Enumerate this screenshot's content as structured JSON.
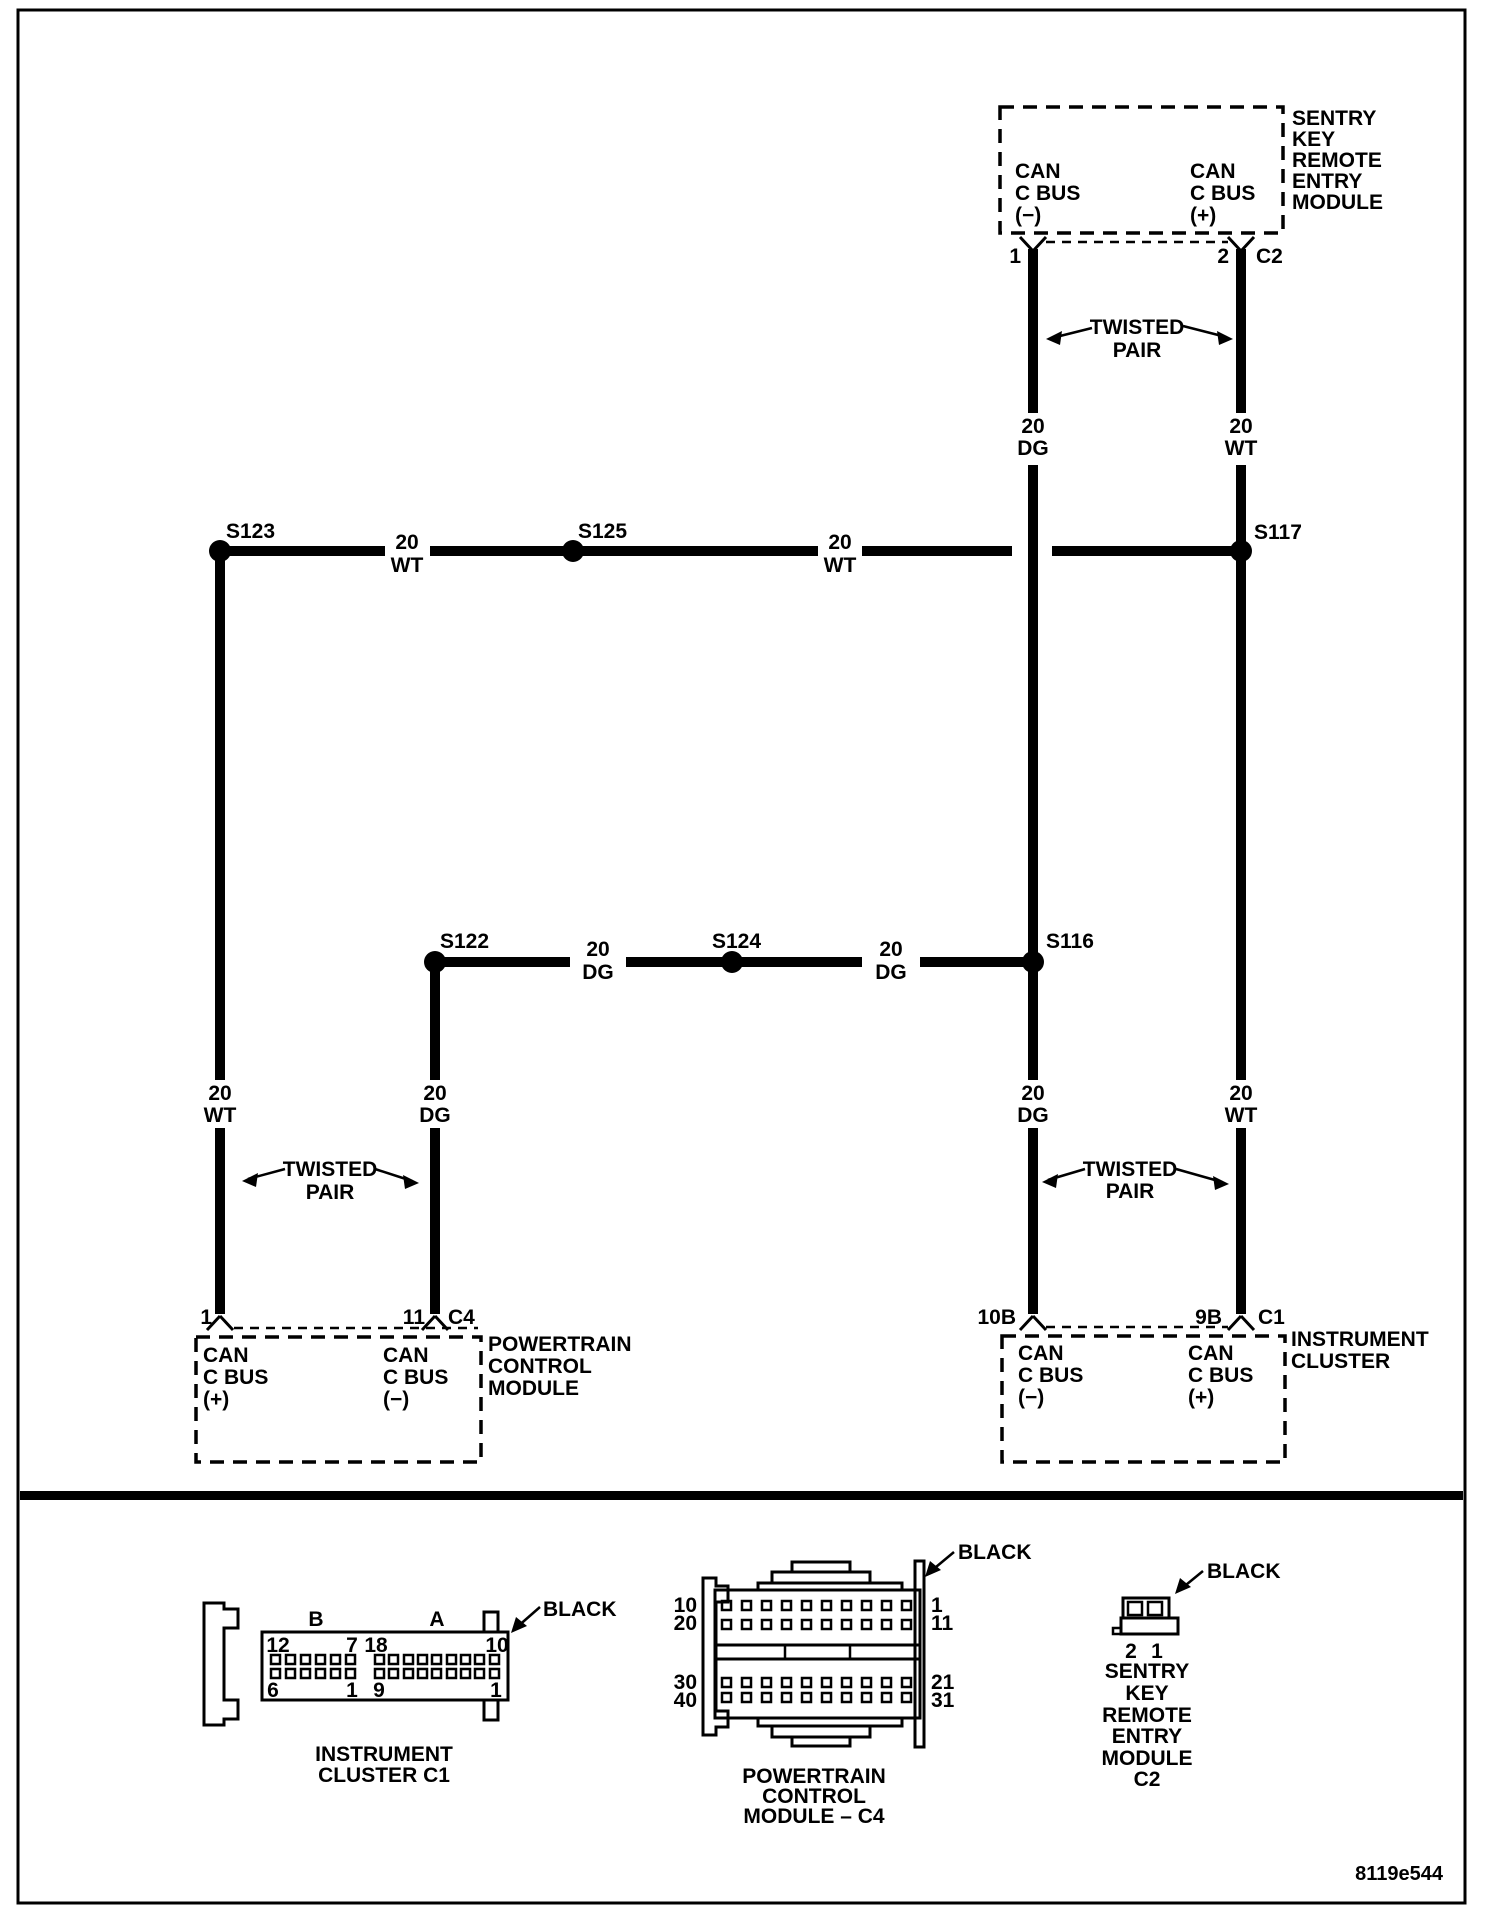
{
  "figure_number": "8119e544",
  "labels": {
    "gauge": "20",
    "wt": "WT",
    "dg": "DG",
    "twisted": "TWISTED",
    "pair": "PAIR",
    "black": "BLACK",
    "can": "CAN",
    "cbus": "C BUS",
    "plus": "(+)",
    "minus": "(−)"
  },
  "splices": {
    "s123": "S123",
    "s125": "S125",
    "s117": "S117",
    "s122": "S122",
    "s124": "S124",
    "s116": "S116"
  },
  "skreem": {
    "name": [
      "SENTRY",
      "KEY",
      "REMOTE",
      "ENTRY",
      "MODULE"
    ],
    "pin1": "1",
    "pin2": "2",
    "connector": "C2"
  },
  "pcm": {
    "name": [
      "POWERTRAIN",
      "CONTROL",
      "MODULE"
    ],
    "pin1": "1",
    "pin2": "11",
    "connector": "C4"
  },
  "cluster": {
    "name": [
      "INSTRUMENT",
      "CLUSTER"
    ],
    "pin1": "10B",
    "pin2": "9B",
    "connector": "C1"
  },
  "connector_views": {
    "c1": {
      "caption": [
        "INSTRUMENT",
        "CLUSTER C1"
      ],
      "section_b": "B",
      "section_a": "A",
      "pin_top_left": "12",
      "pin_top_mid_left": "7",
      "pin_top_mid_right": "18",
      "pin_top_right": "10",
      "pin_bottom_left": "6",
      "pin_bottom_mid_left": "1",
      "pin_bottom_mid_right": "9",
      "pin_bottom_right": "1"
    },
    "c4": {
      "caption": [
        "POWERTRAIN",
        "CONTROL",
        "MODULE – C4"
      ],
      "row_labels_left": [
        "10",
        "20",
        "30",
        "40"
      ],
      "row_labels_right": [
        "1",
        "11",
        "21",
        "31"
      ]
    },
    "c2": {
      "caption": [
        "SENTRY",
        "KEY",
        "REMOTE",
        "ENTRY",
        "MODULE",
        "C2"
      ],
      "pin_left": "2",
      "pin_right": "1"
    }
  }
}
